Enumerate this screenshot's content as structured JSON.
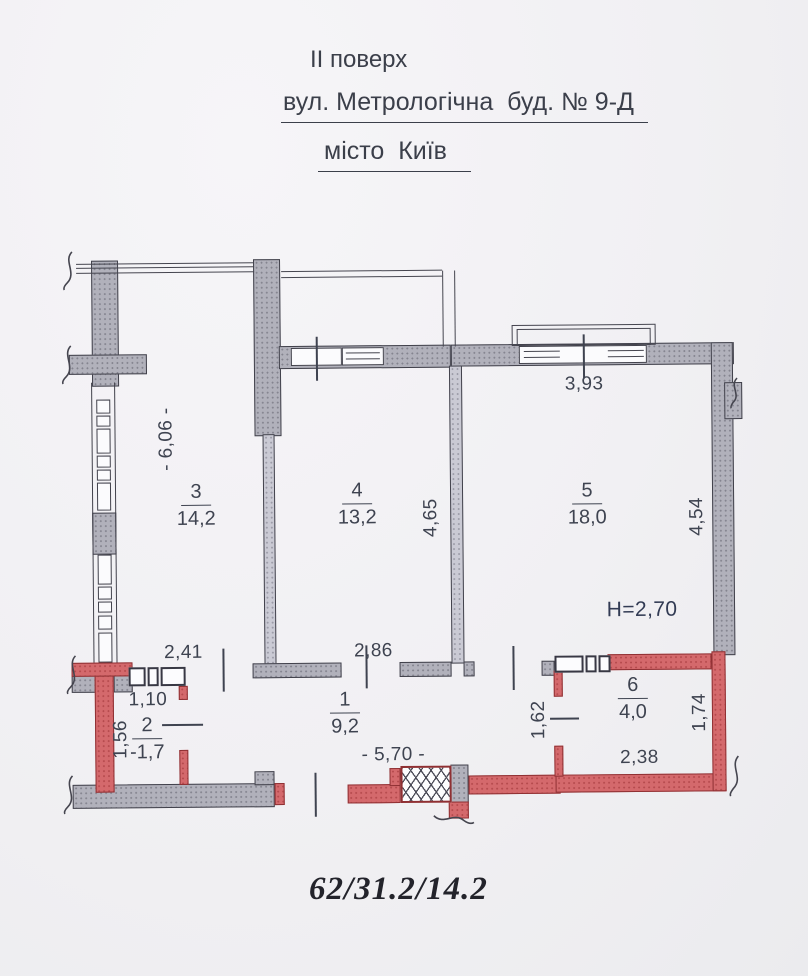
{
  "header": {
    "floor_label": "II поверх",
    "address_line": "вул. Метрологічна  буд. № 9-Д",
    "city_line": "місто  Київ"
  },
  "plan": {
    "ceiling_height": "H=2,70",
    "rooms": {
      "r1": {
        "number": "1",
        "area": "9,2"
      },
      "r2": {
        "number": "2",
        "area": "-1,7"
      },
      "r3": {
        "number": "3",
        "area": "14,2"
      },
      "r4": {
        "number": "4",
        "area": "13,2"
      },
      "r5": {
        "number": "5",
        "area": "18,0"
      },
      "r6": {
        "number": "6",
        "area": "4,0"
      }
    },
    "dimensions": {
      "left_wall_height": "- 6,06 -",
      "top_right_window": "3,93",
      "mid_wall": "4,65",
      "right_wall": "4,54",
      "corridor_seg_left": "2,41",
      "corridor_seg_right": "2,86",
      "room2_door_width": "1,10",
      "room2_depth": "1,56",
      "corridor_length": "- 5,70 -",
      "room6_left": "1,62",
      "room6_width": "2,38",
      "room6_right": "1,74"
    }
  },
  "footer": {
    "apartment_areas": "62/31.2/14.2"
  },
  "colors": {
    "wall_gray": "#b1b1bb",
    "wall_red": "#d4696c",
    "ink": "#3e4350",
    "paper": "#f1f0f3"
  }
}
